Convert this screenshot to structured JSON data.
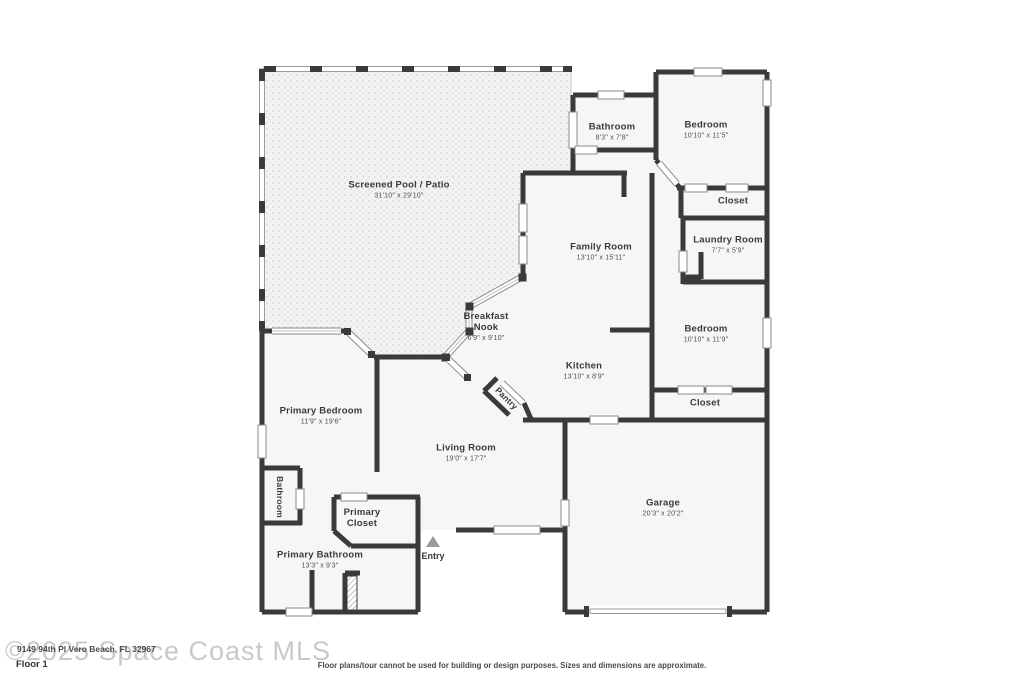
{
  "footer": {
    "watermark": "©2025 Space Coast MLS",
    "address": "9149 94th Pl Vero Beach, FL 32967",
    "floor_label": "Floor 1",
    "disclaimer": "Floor plans/tour cannot be used for building or design purposes. Sizes and dimensions are approximate."
  },
  "entry_label": "Entry",
  "rooms": [
    {
      "name": "Screened Pool / Patio",
      "dims": "31'10\" x 29'10\""
    },
    {
      "name": "Bathroom",
      "dims": "8'3\" x 7'8\""
    },
    {
      "name": "Bedroom",
      "dims": "10'10\" x 11'5\""
    },
    {
      "name": "Closet",
      "dims": ""
    },
    {
      "name": "Laundry Room",
      "dims": "7'7\" x 5'9\""
    },
    {
      "name": "Family Room",
      "dims": "13'10\" x 15'11\""
    },
    {
      "name": "Breakfast Nook",
      "dims": "6'9\" x 9'10\""
    },
    {
      "name": "Kitchen",
      "dims": "13'10\" x 8'9\""
    },
    {
      "name": "Bedroom",
      "dims": "10'10\" x 11'9\""
    },
    {
      "name": "Closet",
      "dims": ""
    },
    {
      "name": "Primary Bedroom",
      "dims": "11'9\" x 19'6\""
    },
    {
      "name": "Living Room",
      "dims": "19'0\" x 17'7\""
    },
    {
      "name": "Pantry",
      "dims": ""
    },
    {
      "name": "Bathroom",
      "dims": ""
    },
    {
      "name": "Primary Closet",
      "dims": ""
    },
    {
      "name": "Primary Bathroom",
      "dims": "13'3\" x 9'3\""
    },
    {
      "name": "Garage",
      "dims": "20'3\" x 20'2\""
    }
  ],
  "colors": {
    "wall": "#3a3a3a",
    "floor": "#f6f6f6",
    "pool_base": "#f3f3f3",
    "pool_dot": "#e0e0e0",
    "window_frame": "#8a8a8a",
    "watermark": "#c9c9c9",
    "entry_marker": "#9a9a9a"
  }
}
